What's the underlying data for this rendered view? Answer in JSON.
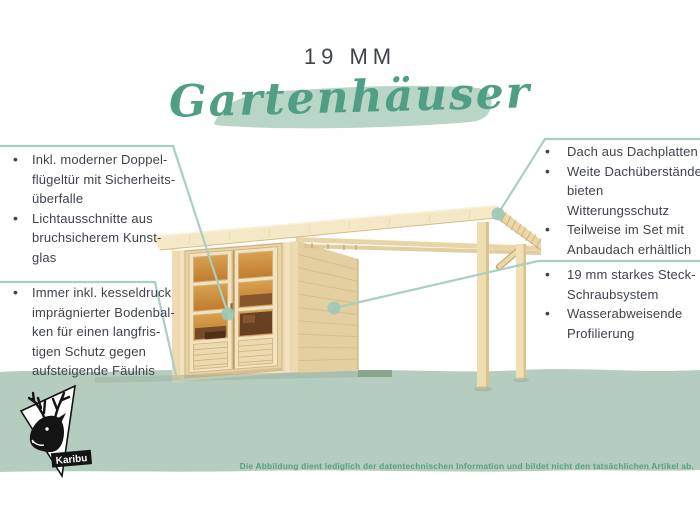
{
  "header": {
    "subtitle": "19 MM",
    "title": "Gartenhäuser"
  },
  "ui": {
    "bullet": "•"
  },
  "callouts": {
    "left_top": {
      "items": [
        {
          "text": "Inkl. moderner Doppel-\nflügeltür mit Sicherheits-\nüberfalle"
        },
        {
          "text": "Lichtausschnitte aus\nbruchsicherem Kunst-\nglas"
        }
      ]
    },
    "left_bottom": {
      "items": [
        {
          "text": "Immer inkl. kesseldruck\nimprägnierter Bodenbal-\nken für einen langfris-\ntigen Schutz gegen\naufsteigende Fäulnis"
        }
      ]
    },
    "right_top": {
      "items": [
        {
          "text": "Dach aus Dachplatten"
        },
        {
          "text": "Weite Dachüberstände\nbieten Witterungsschutz"
        },
        {
          "text": "Teilweise im Set mit\nAnbaudach erhältlich"
        }
      ]
    },
    "right_bottom": {
      "items": [
        {
          "text": "19 mm starkes Steck-\nSchraubsystem"
        },
        {
          "text": "Wasserabweisende\nProfilierung"
        }
      ]
    }
  },
  "footer": {
    "brand": "Karibu",
    "disclaimer": "Die Abbildung dient lediglich der datentechnischen Information und bildet nicht den tatsächlichen Artikel ab."
  },
  "illustration": {
    "description": "Holz-Gartenhaus mit Doppelflügeltür, Flachdach und seitlichem Anbaudach auf zwei Pfosten"
  },
  "colors": {
    "page_bg": "#ffffff",
    "band_green": "#b5cdbf",
    "brush_green": "#b9d5c6",
    "title_green": "#4f9e85",
    "callout_line": "#a9cfc2",
    "dot_fill": "#9cc8b8",
    "text_dark": "#3e434d",
    "fineprint_green": "#55a27c",
    "wood_light": "#f2e2bd",
    "wood_mid": "#e3cfa0",
    "wood_fascia": "#f5e8c6",
    "glass_top": "#d9a050",
    "glass_bottom": "#c07c2e",
    "logo_ink": "#141414"
  }
}
